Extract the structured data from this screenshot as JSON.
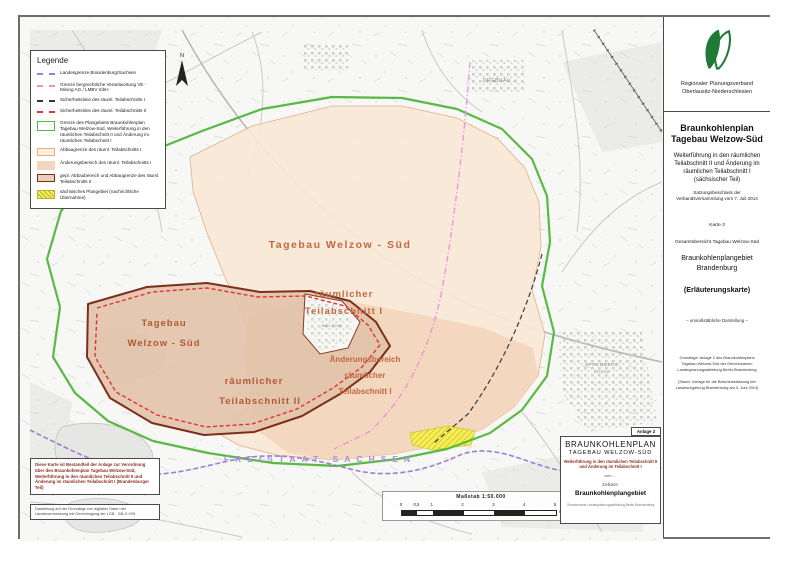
{
  "legend": {
    "title": "Legende",
    "items": [
      {
        "label": "Landesgrenze Brandenburg/Sachsen"
      },
      {
        "label": "Grenze bergrechtliche Verantwortung VE - Mining AG / LMBV mbH"
      },
      {
        "label": "Sicherheitslinie des räuml. Teilabschnitts I"
      },
      {
        "label": "Sicherheitslinie des räuml. Teilabschnitts II"
      },
      {
        "label": "Grenze des Plangebiets Braunkohlenplan Tagebau Welzow-Süd, Weiterführung in den räumlichen Teilabschnitt II und Änderung im räumlichen Teilabschnitt I"
      },
      {
        "label": "Abbaugrenze des räuml. Teilabschnitts I"
      },
      {
        "label": "Änderungsbereich des räuml. Teilabschnitts I"
      },
      {
        "label": "gepl. Abbaubereich und Abbaugrenze des räuml. Teilabschnitts II"
      },
      {
        "label": "sächsisches Plangebiet (nachrichtliche Übernahme)"
      }
    ]
  },
  "map": {
    "labels": {
      "tagebau_ta1": "Tagebau  Welzow - Süd",
      "ta1_a": "räumlicher",
      "ta1_b": "Teilabschnitt I",
      "tagebau_ta2_a": "Tagebau",
      "tagebau_ta2_b": "Welzow - Süd",
      "ta2_a": "räumlicher",
      "ta2_b": "Teilabschnitt II",
      "aenderung_a": "Änderungsbereich",
      "aenderung_b": "räumlicher",
      "aenderung_c": "Teilabschnitt I",
      "state_border": "FREISTAAT SACHSEN",
      "north": "N"
    },
    "towns": {
      "drebkau": "DREBKAU",
      "welzow": "WELZOW",
      "spremberg": "SPREMBERG",
      "grodk": "GRODK"
    }
  },
  "scalebar": {
    "title": "Maßstab 1:50.000",
    "ticks": [
      "0",
      "0,5",
      "1",
      "2",
      "3",
      "4",
      "5"
    ],
    "unit": "Kilometer"
  },
  "source_box": {
    "main": "Diese Karte ist Bestandteil der Anlage zur Verordnung über den Braunkohlenplan Tagebau Welzow-Süd, Weiterführung in den räumlichen Teilabschnitt II und Änderung im räumlichen Teilabschnitt I (Brandenburger Teil)",
    "credit": "Darstellung auf der Grundlage von digitalen Daten der Landesvermessung mit Genehmigung der LGB · GB-G I/99"
  },
  "plan_box": {
    "badge": "Anlage 2",
    "title": "BRAUNKOHLENPLAN",
    "subtitle": "TAGEBAU WELZOW-SÜD",
    "description": "Weiterführung in den räumlichen Teilabschnitt II und Änderung im Teilabschnitt I",
    "vom": "vom ....",
    "ziel_label": "Zielkarte:",
    "ziel_value": "Braunkohlenplangebiet",
    "footer": "Gemeinsame Landesplanungsabteilung Berlin-Brandenburg"
  },
  "panel": {
    "org_line1": "Regionaler Planungsverband",
    "org_line2": "Oberlausitz-Niederschlesien",
    "title_line1": "Braunkohlenplan",
    "title_line2": "Tagebau Welzow-Süd",
    "subtitle": "Weiterführung in den räumlichen Teilabschnitt II und Änderung im räumlichen Teilabschnitt I (sächsischer Teil)",
    "resolution": "Satzungsbeschluss der Verbandsversammlung vom 7. Juli 2014",
    "map_no": "Karte 3",
    "overview": "Gesamtübersicht Tagebau Welzow-Süd",
    "region_line1": "Braunkohlenplangebiet",
    "region_line2": "Brandenburg",
    "kind": "(Erläuterungskarte)",
    "scale_note": "– unmaßstäbliche Darstellung –",
    "basis": "Grundlage: Anlage 2 des Braunkohlenplans Tagebau Welzow-Süd der Gemeinsamen Landesplanungsabteilung Berlin-Brandenburg",
    "stand": "(Stand: Vorlage für die Beschlussfassung der Landesregierung Brandenburg am 3. Juni 2014)"
  },
  "colors": {
    "plan_boundary_green": "#58b944",
    "state_border_purple": "#9b7fd4",
    "mining_boundary_pink": "#ee8fdc",
    "safety_line_red": "#e23333",
    "ta1_fill_peach": "#f9e7d5",
    "change_area_fill": "#f2d6bd",
    "ta2_fill_brown": "#e2c3aa",
    "ta2_border_brown": "#7c2d1c",
    "saxon_area_yellow": "#f7ef52",
    "logo_green": "#1e7a34",
    "map_label_orange": "#c06a42"
  }
}
